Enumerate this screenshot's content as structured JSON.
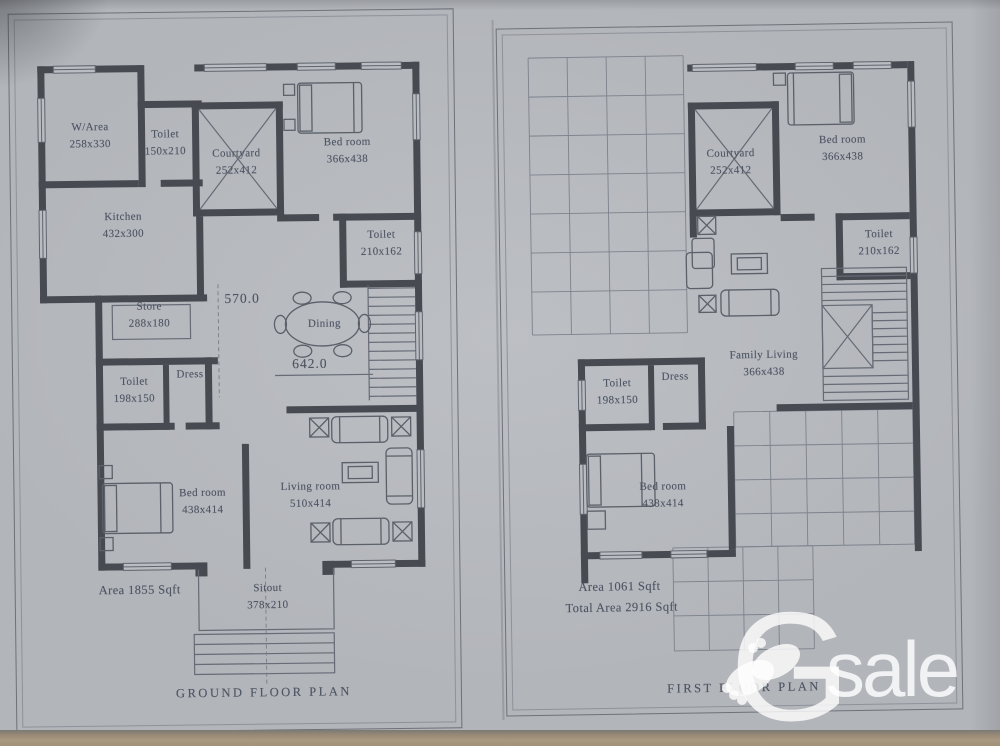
{
  "ground_floor": {
    "title": "GROUND FLOOR PLAN",
    "area_total": "Area 1855 Sqft",
    "dim_vertical": "570.0",
    "dim_horizontal": "642.0",
    "rooms": {
      "warea": {
        "name": "W/Area",
        "size": "258x330"
      },
      "toilet_top": {
        "name": "Toilet",
        "size": "150x210"
      },
      "courtyard": {
        "name": "Courtyard",
        "size": "252x412"
      },
      "bed_top": {
        "name": "Bed room",
        "size": "366x438"
      },
      "kitchen": {
        "name": "Kitchen",
        "size": "432x300"
      },
      "toilet_right": {
        "name": "Toilet",
        "size": "210x162"
      },
      "store": {
        "name": "Store",
        "size": "288x180"
      },
      "dining": {
        "name": "Dining",
        "size": ""
      },
      "toilet_mid": {
        "name": "Toilet",
        "size": "198x150"
      },
      "dress": {
        "name": "Dress",
        "size": ""
      },
      "bed_bottom": {
        "name": "Bed room",
        "size": "438x414"
      },
      "living": {
        "name": "Living room",
        "size": "510x414"
      },
      "sitout": {
        "name": "Sitout",
        "size": "378x210"
      }
    }
  },
  "first_floor": {
    "title": "FIRST FLOOR PLAN",
    "area_floor": "Area 1061 Sqft",
    "area_total": "Total Area 2916 Sqft",
    "rooms": {
      "courtyard": {
        "name": "Courtyard",
        "size": "252x412"
      },
      "bed_top": {
        "name": "Bed room",
        "size": "366x438"
      },
      "toilet_right": {
        "name": "Toilet",
        "size": "210x162"
      },
      "family_living": {
        "name": "Family Living",
        "size": "366x438"
      },
      "toilet_mid": {
        "name": "Toilet",
        "size": "198x150"
      },
      "dress": {
        "name": "Dress",
        "size": ""
      },
      "bed_bottom": {
        "name": "Bed room",
        "size": "438x414"
      }
    }
  },
  "watermark": {
    "letter": "G",
    "text": "sale"
  },
  "colors": {
    "wall": "#474a50",
    "thin_line": "#666b75",
    "text": "#4d5462",
    "paper": "#b6b9be",
    "table_edge": "#a29078",
    "watermark": "#ffffff"
  }
}
